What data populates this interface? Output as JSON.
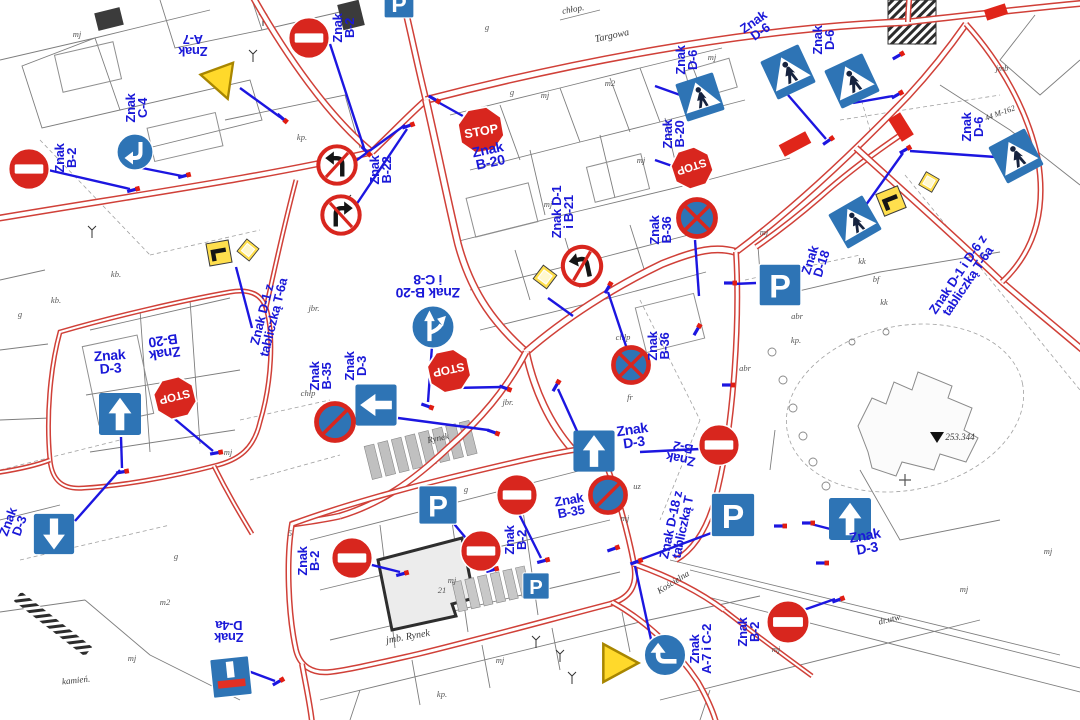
{
  "palette": {
    "label_blue": "#1a18d8",
    "sign_blue": "#2e74b5",
    "sign_red": "#d8261e",
    "sign_yellow": "#ffd92b",
    "road_red": "#d04038",
    "connector_blue": "#1c16e0",
    "crosswalk_red": "#e0251a"
  },
  "glyphs": {
    "stop": "STOP",
    "parking": "P"
  },
  "sign_labels": [
    {
      "t": "Znak\nA-7",
      "x": 193,
      "y": 45,
      "r": 180
    },
    {
      "t": "Znak\nC-4",
      "x": 137,
      "y": 108,
      "r": -90
    },
    {
      "t": "Znak\nB-2",
      "x": 66,
      "y": 158,
      "r": -90
    },
    {
      "t": "Znak\nB-2",
      "x": 344,
      "y": 28,
      "r": -90
    },
    {
      "t": "Znak\nB-20",
      "x": 489,
      "y": 156,
      "r": -12,
      "s": 14
    },
    {
      "t": "Znak\nB-22",
      "x": 381,
      "y": 170,
      "r": -90
    },
    {
      "t": "Znak D-1\ni B-21",
      "x": 563,
      "y": 212,
      "r": -90
    },
    {
      "t": "Znak\nD-6",
      "x": 757,
      "y": 27,
      "r": -35
    },
    {
      "t": "Znak\nD-6",
      "x": 824,
      "y": 40,
      "r": -90
    },
    {
      "t": "Znak\nD-6",
      "x": 687,
      "y": 60,
      "r": -90
    },
    {
      "t": "Znak\nB-20",
      "x": 674,
      "y": 134,
      "r": -90
    },
    {
      "t": "Znak\nB-36",
      "x": 661,
      "y": 230,
      "r": -90
    },
    {
      "t": "Znak B-20\ni C-8",
      "x": 428,
      "y": 286,
      "r": 180,
      "s": 14
    },
    {
      "t": "Znak D-1 z\ntabliczką T-6a",
      "x": 268,
      "y": 316,
      "r": -76
    },
    {
      "t": "Znak\nB-35",
      "x": 321,
      "y": 376,
      "r": -90
    },
    {
      "t": "Znak\nD-3",
      "x": 356,
      "y": 366,
      "r": -90
    },
    {
      "t": "Znak\nD-3",
      "x": 110,
      "y": 362,
      "r": -4,
      "s": 14
    },
    {
      "t": "Znak\nB-20",
      "x": 164,
      "y": 347,
      "r": 172,
      "s": 14
    },
    {
      "t": "Znak\nB-36",
      "x": 659,
      "y": 346,
      "r": -90
    },
    {
      "t": "Znak\nD-3",
      "x": 633,
      "y": 436,
      "r": -8,
      "s": 14
    },
    {
      "t": "Znak\nB-2",
      "x": 682,
      "y": 453,
      "r": 192
    },
    {
      "t": "Znak D-18 z\ntabliczką T",
      "x": 677,
      "y": 526,
      "r": -78
    },
    {
      "t": "Znak\nB-35",
      "x": 570,
      "y": 506,
      "r": -10
    },
    {
      "t": "Znak\nB-2",
      "x": 516,
      "y": 540,
      "r": -90
    },
    {
      "t": "Znak\nB-2",
      "x": 309,
      "y": 561,
      "r": -90
    },
    {
      "t": "Znak D-1 i D-6 z\ntabliczką T-6a",
      "x": 963,
      "y": 278,
      "r": -56
    },
    {
      "t": "Znak\nD-18",
      "x": 816,
      "y": 262,
      "r": -72
    },
    {
      "t": "Znak\nD-3",
      "x": 866,
      "y": 542,
      "r": -10,
      "s": 14
    },
    {
      "t": "Znak\nB-2",
      "x": 749,
      "y": 632,
      "r": -90
    },
    {
      "t": "Znak\nA-7 i C-2",
      "x": 701,
      "y": 649,
      "r": -90
    },
    {
      "t": "Znak\nD-4a",
      "x": 229,
      "y": 631,
      "r": 180
    },
    {
      "t": "Znak\nD-3",
      "x": 14,
      "y": 524,
      "r": -70
    },
    {
      "t": "Znak\nD-6",
      "x": 973,
      "y": 127,
      "r": -90
    }
  ],
  "street_names": [
    {
      "t": "Targowa",
      "x": 612,
      "y": 36,
      "r": -12,
      "s": 10
    },
    {
      "t": "Rynek",
      "x": 438,
      "y": 438,
      "r": -12,
      "s": 9
    },
    {
      "t": "jmb. Rynek",
      "x": 408,
      "y": 637,
      "r": -10,
      "s": 10
    },
    {
      "t": "Kościelna",
      "x": 673,
      "y": 582,
      "r": -32,
      "s": 9
    },
    {
      "t": "kamień.",
      "x": 76,
      "y": 680,
      "r": -6,
      "s": 9
    },
    {
      "t": "dr.utw.",
      "x": 890,
      "y": 619,
      "r": -14,
      "s": 9
    },
    {
      "t": "253.344",
      "x": 960,
      "y": 437,
      "r": 0,
      "s": 9
    },
    {
      "t": "44 M-162",
      "x": 1000,
      "y": 113,
      "r": -20,
      "s": 8
    },
    {
      "t": "chłop.",
      "x": 573,
      "y": 9,
      "r": -10,
      "s": 9
    }
  ],
  "parcel_codes": [
    {
      "t": "mj",
      "x": 77,
      "y": 34
    },
    {
      "t": "mj",
      "x": 641,
      "y": 160
    },
    {
      "t": "mj",
      "x": 548,
      "y": 204
    },
    {
      "t": "mj",
      "x": 712,
      "y": 57
    },
    {
      "t": "mj",
      "x": 764,
      "y": 232
    },
    {
      "t": "mj",
      "x": 228,
      "y": 452
    },
    {
      "t": "mj",
      "x": 625,
      "y": 518
    },
    {
      "t": "mj",
      "x": 452,
      "y": 580
    },
    {
      "t": "mj",
      "x": 132,
      "y": 658
    },
    {
      "t": "mj",
      "x": 776,
      "y": 649
    },
    {
      "t": "mj",
      "x": 500,
      "y": 660
    },
    {
      "t": "mj",
      "x": 1048,
      "y": 551
    },
    {
      "t": "mj",
      "x": 964,
      "y": 589
    },
    {
      "t": "mj",
      "x": 545,
      "y": 95
    },
    {
      "t": "g",
      "x": 20,
      "y": 314
    },
    {
      "t": "g",
      "x": 487,
      "y": 27
    },
    {
      "t": "g",
      "x": 512,
      "y": 92
    },
    {
      "t": "g",
      "x": 591,
      "y": 249
    },
    {
      "t": "g",
      "x": 466,
      "y": 489
    },
    {
      "t": "g",
      "x": 176,
      "y": 556
    },
    {
      "t": "kp.",
      "x": 796,
      "y": 340
    },
    {
      "t": "kp.",
      "x": 442,
      "y": 694
    },
    {
      "t": "kp.",
      "x": 302,
      "y": 137
    },
    {
      "t": "kb.",
      "x": 116,
      "y": 274
    },
    {
      "t": "kb.",
      "x": 56,
      "y": 300
    },
    {
      "t": "m2",
      "x": 610,
      "y": 83
    },
    {
      "t": "m2",
      "x": 165,
      "y": 602
    },
    {
      "t": "jbr.",
      "x": 314,
      "y": 308
    },
    {
      "t": "jbr.",
      "x": 508,
      "y": 402
    },
    {
      "t": "chłp",
      "x": 308,
      "y": 393
    },
    {
      "t": "chłp",
      "x": 623,
      "y": 337
    },
    {
      "t": "abr",
      "x": 797,
      "y": 316
    },
    {
      "t": "abr",
      "x": 745,
      "y": 368
    },
    {
      "t": "bf",
      "x": 876,
      "y": 279
    },
    {
      "t": "kk",
      "x": 862,
      "y": 261
    },
    {
      "t": "kk",
      "x": 884,
      "y": 302
    },
    {
      "t": "fr",
      "x": 630,
      "y": 397
    },
    {
      "t": "uz",
      "x": 637,
      "y": 486
    },
    {
      "t": "jmb",
      "x": 1002,
      "y": 68
    },
    {
      "t": "jmb",
      "x": 850,
      "y": 212
    },
    {
      "t": "21",
      "x": 442,
      "y": 590
    },
    {
      "t": "5",
      "x": 290,
      "y": 533
    }
  ],
  "signs": [
    {
      "t": "noentry",
      "x": 29,
      "y": 169,
      "s": 44
    },
    {
      "t": "turn",
      "x": 135,
      "y": 152,
      "s": 40,
      "r": 180
    },
    {
      "t": "yield",
      "x": 222,
      "y": 83,
      "s": 42,
      "r": -20
    },
    {
      "t": "noentry",
      "x": 309,
      "y": 38,
      "s": 44
    },
    {
      "t": "stop",
      "x": 481,
      "y": 130,
      "s": 48,
      "r": -10
    },
    {
      "t": "noturnL",
      "x": 337,
      "y": 165,
      "s": 42
    },
    {
      "t": "noturnR",
      "x": 341,
      "y": 215,
      "s": 42
    },
    {
      "t": "crossing",
      "x": 788,
      "y": 72,
      "s": 48,
      "r": -25
    },
    {
      "t": "crossing",
      "x": 852,
      "y": 81,
      "s": 48,
      "r": -25
    },
    {
      "t": "crossing",
      "x": 700,
      "y": 97,
      "s": 45,
      "r": -18
    },
    {
      "t": "stop",
      "x": 692,
      "y": 168,
      "s": 43,
      "r": 162
    },
    {
      "t": "nostopX",
      "x": 697,
      "y": 218,
      "s": 42
    },
    {
      "t": "t6a",
      "x": 219,
      "y": 253,
      "s": 29,
      "r": -10
    },
    {
      "t": "diamond",
      "x": 248,
      "y": 250,
      "s": 25,
      "r": -6
    },
    {
      "t": "diamond",
      "x": 545,
      "y": 277,
      "s": 27,
      "r": -8
    },
    {
      "t": "noturnL",
      "x": 582,
      "y": 266,
      "s": 43,
      "r": -12
    },
    {
      "t": "fork",
      "x": 433,
      "y": 327,
      "s": 47
    },
    {
      "t": "stop",
      "x": 449,
      "y": 371,
      "s": 45,
      "r": 168
    },
    {
      "t": "arrow",
      "x": 376,
      "y": 405,
      "s": 47,
      "r": -90
    },
    {
      "t": "nopark",
      "x": 335,
      "y": 422,
      "s": 42
    },
    {
      "t": "nostopX",
      "x": 631,
      "y": 365,
      "s": 40
    },
    {
      "t": "arrow",
      "x": 120,
      "y": 414,
      "s": 48
    },
    {
      "t": "stop",
      "x": 175,
      "y": 398,
      "s": 44,
      "r": 166
    },
    {
      "t": "arrow",
      "x": 594,
      "y": 451,
      "s": 47
    },
    {
      "t": "noentry",
      "x": 719,
      "y": 445,
      "s": 44
    },
    {
      "t": "nopark",
      "x": 608,
      "y": 495,
      "s": 40
    },
    {
      "t": "parking",
      "x": 733,
      "y": 515,
      "s": 50
    },
    {
      "t": "parking",
      "x": 780,
      "y": 285,
      "s": 48
    },
    {
      "t": "crossing",
      "x": 1016,
      "y": 156,
      "s": 47,
      "r": -28
    },
    {
      "t": "crossing",
      "x": 855,
      "y": 222,
      "s": 45,
      "r": -30
    },
    {
      "t": "t6a",
      "x": 891,
      "y": 201,
      "s": 30,
      "r": -22
    },
    {
      "t": "diamond",
      "x": 929,
      "y": 182,
      "s": 24,
      "r": -15
    },
    {
      "t": "parking",
      "x": 438,
      "y": 505,
      "s": 44
    },
    {
      "t": "noentry",
      "x": 517,
      "y": 495,
      "s": 44
    },
    {
      "t": "noentry",
      "x": 481,
      "y": 551,
      "s": 44
    },
    {
      "t": "noentry",
      "x": 352,
      "y": 558,
      "s": 44
    },
    {
      "t": "parking",
      "x": 536,
      "y": 586,
      "s": 30
    },
    {
      "t": "arrow",
      "x": 850,
      "y": 519,
      "s": 48
    },
    {
      "t": "noentry",
      "x": 788,
      "y": 622,
      "s": 46
    },
    {
      "t": "yield",
      "x": 620,
      "y": 663,
      "s": 46,
      "r": -90
    },
    {
      "t": "turn",
      "x": 665,
      "y": 655,
      "s": 46,
      "r": -90
    },
    {
      "t": "deadend",
      "x": 231,
      "y": 677,
      "s": 46,
      "r": -6
    },
    {
      "t": "arrow",
      "x": 54,
      "y": 534,
      "s": 46,
      "r": 180
    },
    {
      "t": "parking",
      "x": 399,
      "y": 3,
      "s": 34
    }
  ],
  "connectors": [
    [
      48,
      170,
      130,
      189
    ],
    [
      142,
      168,
      182,
      176
    ],
    [
      240,
      88,
      280,
      117
    ],
    [
      330,
      44,
      364,
      148
    ],
    [
      346,
      168,
      405,
      125
    ],
    [
      350,
      214,
      407,
      129
    ],
    [
      470,
      120,
      436,
      101
    ],
    [
      788,
      95,
      826,
      139
    ],
    [
      853,
      103,
      893,
      96
    ],
    [
      683,
      96,
      655,
      86
    ],
    [
      678,
      168,
      655,
      160
    ],
    [
      695,
      240,
      699,
      296
    ],
    [
      1010,
      158,
      910,
      151
    ],
    [
      853,
      223,
      903,
      153
    ],
    [
      433,
      332,
      428,
      402
    ],
    [
      452,
      388,
      502,
      387
    ],
    [
      398,
      418,
      488,
      430
    ],
    [
      628,
      352,
      608,
      292
    ],
    [
      577,
      431,
      558,
      389
    ],
    [
      700,
      449,
      640,
      452
    ],
    [
      714,
      532,
      639,
      560
    ],
    [
      756,
      283,
      733,
      284
    ],
    [
      440,
      507,
      490,
      567
    ],
    [
      517,
      510,
      541,
      558
    ],
    [
      482,
      553,
      496,
      569
    ],
    [
      352,
      560,
      400,
      572
    ],
    [
      652,
      644,
      635,
      566
    ],
    [
      240,
      668,
      275,
      681
    ],
    [
      75,
      521,
      120,
      470
    ],
    [
      170,
      415,
      213,
      451
    ],
    [
      121,
      437,
      122,
      468
    ],
    [
      236,
      267,
      252,
      328
    ],
    [
      548,
      298,
      573,
      316
    ],
    [
      838,
      531,
      811,
      524
    ],
    [
      792,
      614,
      835,
      599
    ]
  ],
  "posts": [
    [
      133,
      190,
      -15
    ],
    [
      184,
      176,
      -15
    ],
    [
      282,
      118,
      40
    ],
    [
      408,
      126,
      -20
    ],
    [
      366,
      151,
      45
    ],
    [
      434,
      99,
      30
    ],
    [
      505,
      388,
      20
    ],
    [
      556,
      386,
      -60
    ],
    [
      493,
      432,
      20
    ],
    [
      427,
      406,
      20
    ],
    [
      608,
      288,
      -60
    ],
    [
      697,
      330,
      -60
    ],
    [
      730,
      283,
      0
    ],
    [
      728,
      385,
      0
    ],
    [
      898,
      56,
      -30
    ],
    [
      897,
      95,
      -30
    ],
    [
      905,
      150,
      -30
    ],
    [
      828,
      141,
      -35
    ],
    [
      613,
      549,
      -20
    ],
    [
      636,
      562,
      -20
    ],
    [
      122,
      472,
      -10
    ],
    [
      216,
      453,
      -10
    ],
    [
      278,
      682,
      -30
    ],
    [
      780,
      526,
      0
    ],
    [
      808,
      523,
      0
    ],
    [
      822,
      563,
      0
    ],
    [
      838,
      600,
      -20
    ],
    [
      402,
      574,
      -15
    ],
    [
      492,
      570,
      -15
    ],
    [
      543,
      561,
      -15
    ]
  ],
  "crosswalks": [
    [
      795,
      144,
      30,
      13,
      -28
    ],
    [
      901,
      127,
      14,
      26,
      -32
    ],
    [
      996,
      12,
      22,
      11,
      -18
    ]
  ]
}
